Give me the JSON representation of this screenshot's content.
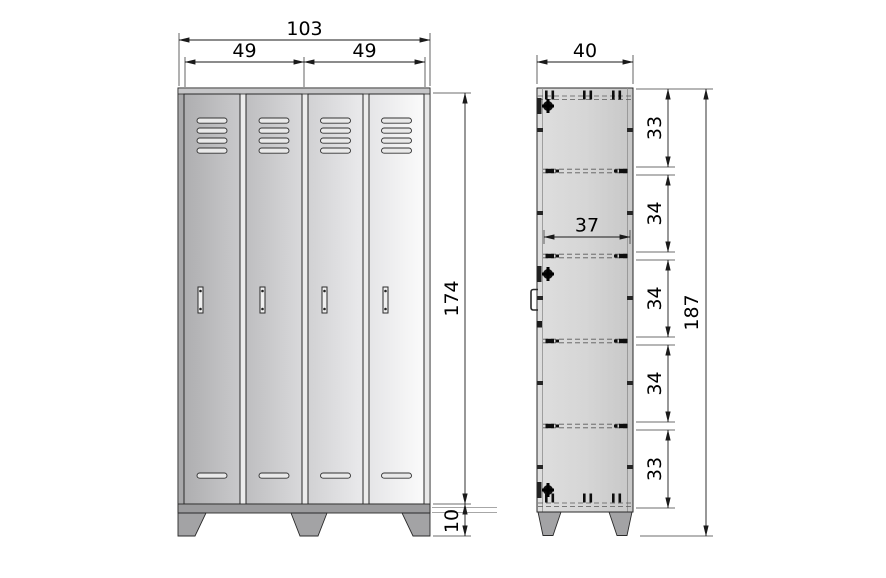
{
  "drawing": {
    "type": "furniture-technical-drawing",
    "subject": "two-door metal locker cabinet, front and side elevation",
    "units_shown": false
  },
  "front_view": {
    "door_count": 4,
    "vent_slots_top_per_door": 4,
    "vent_slots_bottom_per_door": 1,
    "dim_total_width": "103",
    "dim_door_widths": [
      "49",
      "49"
    ],
    "dim_body_height": "174",
    "dim_feet_height": "10"
  },
  "side_view": {
    "shelf_count": 4,
    "dim_depth": "40",
    "dim_interior_depth": "37",
    "dim_total_height": "187",
    "dim_sections": [
      "33",
      "34",
      "34",
      "34",
      "33"
    ]
  },
  "colors": {
    "background": "#ffffff",
    "line": "#1a1a1a",
    "door_dark": "#b3b3b5",
    "door_light": "#fafafa",
    "panel": "#d2d2d2",
    "feet": "#a3a3a5"
  }
}
